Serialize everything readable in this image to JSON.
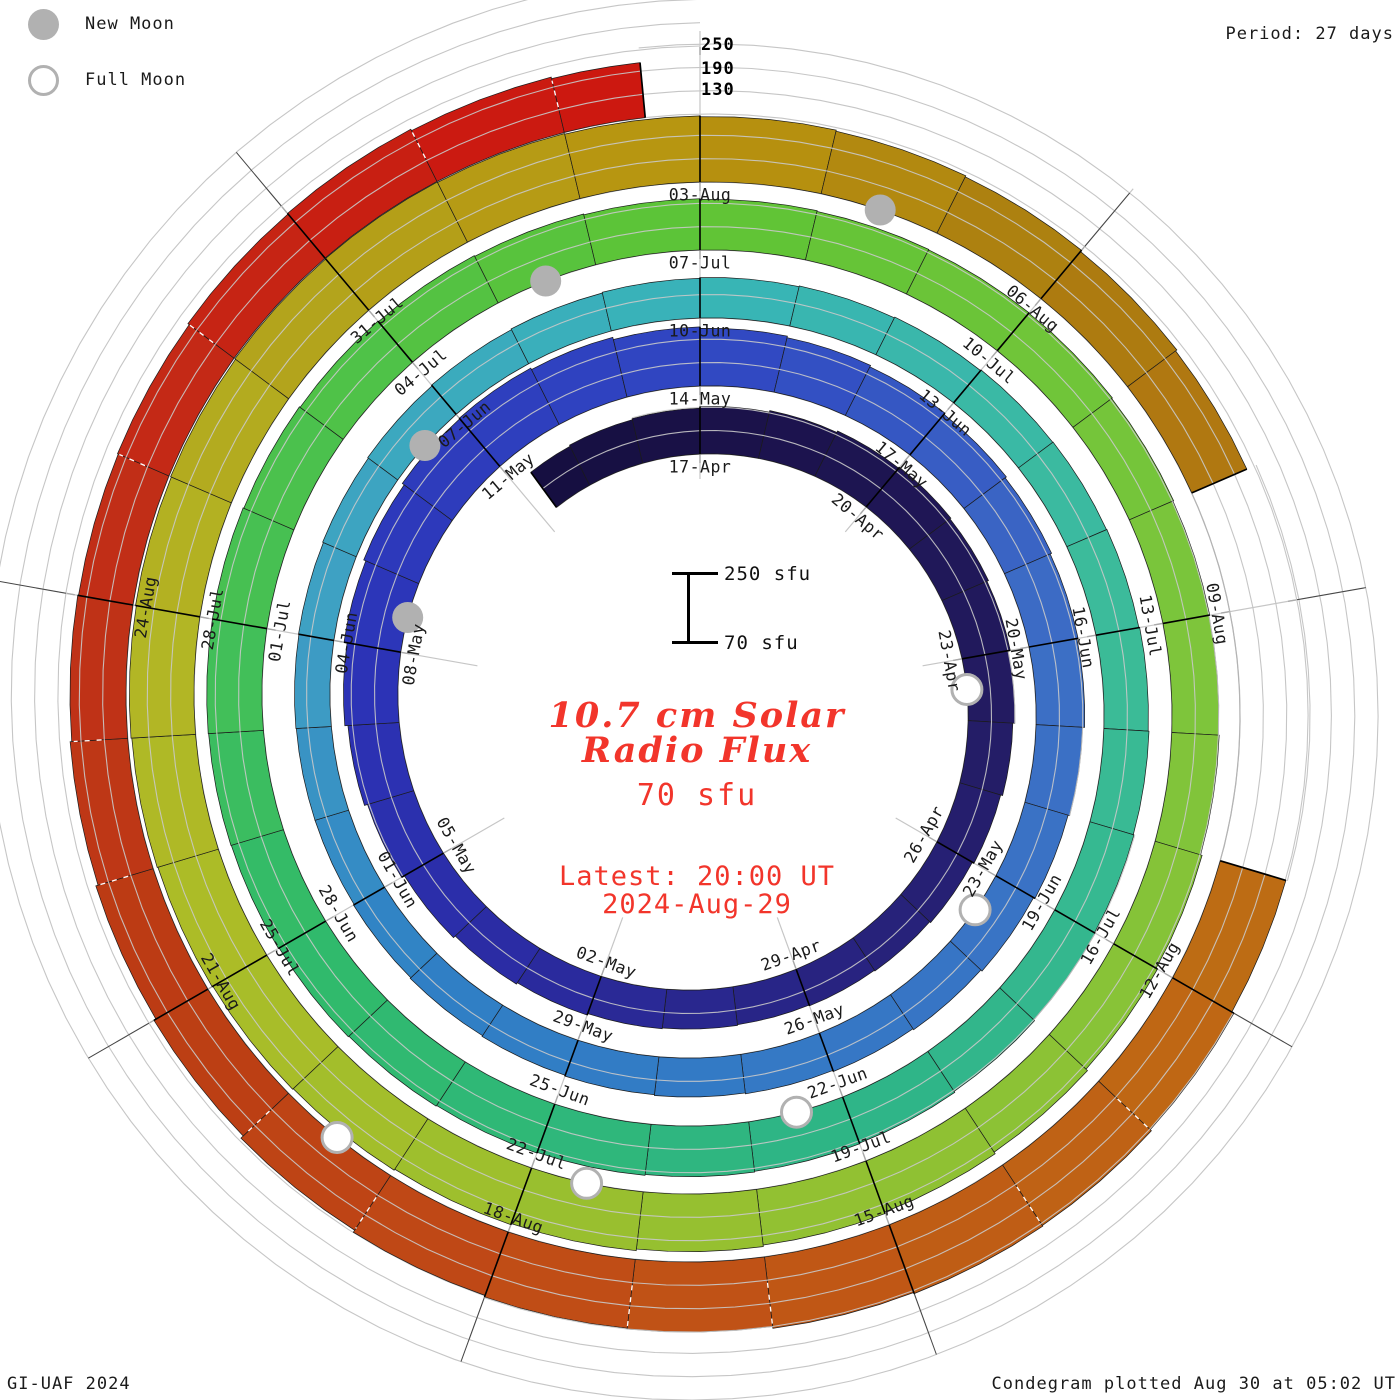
{
  "legend": {
    "new_moon": "New Moon",
    "full_moon": "Full Moon"
  },
  "period_label": "Period: 27 days",
  "radial_axis": [
    "250",
    "190",
    "130"
  ],
  "scale_bar": {
    "top": "250 sfu",
    "bottom": "70 sfu"
  },
  "center": {
    "title_line1": "10.7 cm Solar",
    "title_line2": "Radio Flux",
    "current_value": "70 sfu",
    "latest_line1": "Latest: 20:00 UT",
    "latest_line2": "2024-Aug-29"
  },
  "footer": {
    "credit": "GI-UAF 2024",
    "plotted": "Condegram plotted Aug 30 at 05:02 UT"
  },
  "chart_data": {
    "type": "spiral_bar",
    "title": "10.7 cm Solar Radio Flux",
    "units": "sfu",
    "period_days": 27,
    "start_date": "2024-04-14",
    "end_date": "2024-08-29",
    "latest_reading": {
      "value_sfu": 70,
      "time": "20:00 UT",
      "date": "2024-Aug-29"
    },
    "flux_min": 70,
    "flux_max": 250,
    "gridlines_sfu": [
      70,
      130,
      190,
      250
    ],
    "label_every_days": 3,
    "date_labels": [
      "17-Apr",
      "20-Apr",
      "23-Apr",
      "26-Apr",
      "29-Apr",
      "02-May",
      "05-May",
      "08-May",
      "11-May",
      "14-May",
      "17-May",
      "20-May",
      "23-May",
      "26-May",
      "29-May",
      "01-Jun",
      "04-Jun",
      "07-Jun",
      "10-Jun",
      "13-Jun",
      "16-Jun",
      "19-Jun",
      "22-Jun",
      "25-Jun",
      "28-Jun",
      "01-Jul",
      "04-Jul",
      "07-Jul",
      "10-Jul",
      "13-Jul",
      "16-Jul",
      "19-Jul",
      "22-Jul",
      "25-Jul",
      "28-Jul",
      "31-Jul",
      "03-Aug",
      "06-Aug",
      "09-Aug",
      "12-Aug",
      "15-Aug",
      "18-Aug",
      "21-Aug",
      "24-Aug"
    ],
    "t_start": -3,
    "flux_daily": [
      182,
      185,
      188,
      192,
      196,
      200,
      203,
      200,
      196,
      190,
      185,
      180,
      175,
      172,
      170,
      168,
      170,
      172,
      176,
      180,
      186,
      194,
      202,
      210,
      218,
      224,
      230,
      232,
      228,
      222,
      218,
      214,
      210,
      206,
      202,
      198,
      195,
      190,
      186,
      182,
      178,
      175,
      172,
      170,
      168,
      166,
      164,
      162,
      160,
      160,
      161,
      162,
      164,
      166,
      168,
      170,
      172,
      174,
      176,
      178,
      180,
      181,
      182,
      184,
      186,
      188,
      190,
      193,
      196,
      198,
      200,
      202,
      204,
      206,
      208,
      210,
      211,
      212,
      212,
      210,
      208,
      206,
      204,
      202,
      200,
      198,
      197,
      196,
      194,
      192,
      190,
      192,
      196,
      200,
      205,
      210,
      214,
      218,
      222,
      225,
      228,
      230,
      232,
      234,
      236,
      238,
      240,
      242,
      243,
      242,
      240,
      238,
      235,
      232,
      228,
      224,
      null,
      null,
      null,
      246,
      252,
      256,
      258,
      255,
      250,
      248,
      244,
      238,
      230,
      224,
      218,
      214,
      212,
      214,
      218,
      220,
      216,
      212
    ],
    "missing_data": [
      "2024-08-08",
      "2024-08-09",
      "2024-08-10"
    ],
    "moons": {
      "new_t": [
        21,
        50,
        79,
        109
      ],
      "new_dates": [
        "2024-05-08",
        "2024-06-06",
        "2024-07-05",
        "2024-08-04"
      ],
      "full_t": [
        6,
        36,
        66,
        95,
        124
      ],
      "full_dates": [
        "2024-04-23",
        "2024-05-23",
        "2024-06-22",
        "2024-07-21",
        "2024-08-19"
      ]
    },
    "colormap": [
      [
        -3,
        "#140e3e"
      ],
      [
        0,
        "#1a1148"
      ],
      [
        6,
        "#221a5e"
      ],
      [
        12,
        "#282483"
      ],
      [
        17,
        "#2b2da8"
      ],
      [
        21,
        "#2c34b8"
      ],
      [
        27,
        "#3046c2"
      ],
      [
        33,
        "#3d6ec5"
      ],
      [
        44,
        "#2f80c5"
      ],
      [
        48,
        "#3f9fc4"
      ],
      [
        54,
        "#38b4b8"
      ],
      [
        60,
        "#3cbc98"
      ],
      [
        66,
        "#2eb487"
      ],
      [
        72,
        "#30ba6a"
      ],
      [
        75,
        "#45c055"
      ],
      [
        81,
        "#5ec435"
      ],
      [
        87,
        "#7cc53c"
      ],
      [
        96,
        "#9bbf2e"
      ],
      [
        99,
        "#aabd28"
      ],
      [
        102,
        "#b3b424"
      ],
      [
        105,
        "#b3a11a"
      ],
      [
        108,
        "#b8940f"
      ],
      [
        111,
        "#ab7d10"
      ],
      [
        117,
        "#bf6a14"
      ],
      [
        123,
        "#c04a16"
      ],
      [
        126,
        "#bb3d13"
      ],
      [
        129,
        "#c03018"
      ],
      [
        134,
        "#cc1810"
      ]
    ],
    "geometry": {
      "cx": 700,
      "cy": 705,
      "r0": 251,
      "pitch_px": 68,
      "px_per_sfu": 0.3889,
      "data_t_begin": -2.7,
      "data_t_end": 134.6,
      "track_t_end": 162
    },
    "legend_position": "top-left",
    "grid": true
  }
}
